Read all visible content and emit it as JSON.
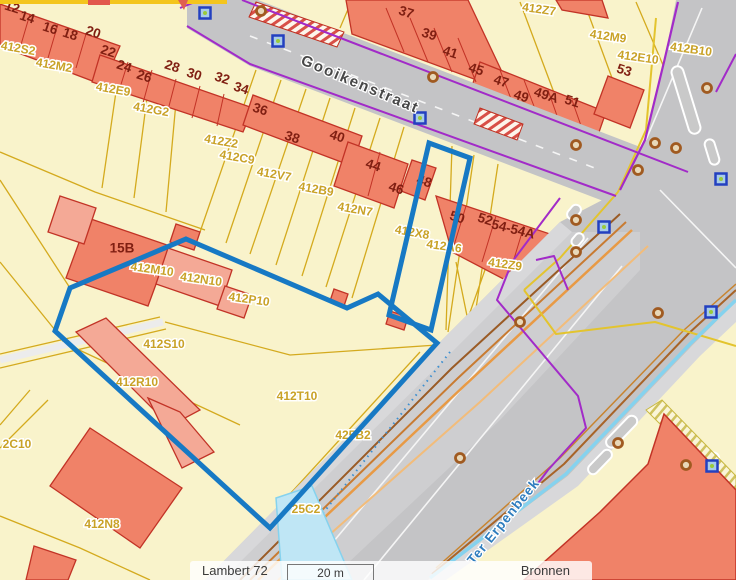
{
  "status_bar": {
    "projection": "Lambert 72",
    "scale_text": "20 m",
    "sources_label": "Bronnen"
  },
  "colors": {
    "selection_blue": "#1779C4",
    "building_fill": "#F08268",
    "building_light": "#F4A996",
    "building_border": "#C23326",
    "parcel_fill": "#F9F3CB",
    "parcel_line": "#D4AA1E",
    "road_gray": "#C4C4C6",
    "sidewalk_gray": "#D8D8DA",
    "utility_purple": "#A22BC8",
    "stream_cyan": "#85D2EE",
    "parcel_label": "#C9A227",
    "house_number": "#801F12",
    "street_label_gray": "#474747",
    "water_label_blue": "#2F7DBE",
    "marker_blue_border": "#2340C0",
    "marker_blue_fill": "#A8CCE8",
    "marker_dot_green": "#9ACB3A",
    "manhole_brown": "#A05A20"
  },
  "map": {
    "street_labels": [
      {
        "t": "Gooikenstraat",
        "x": 360,
        "y": 85,
        "r": 23,
        "color": "#474747",
        "size": 15,
        "spacing": 2
      },
      {
        "t": "Ter Erpenbeek",
        "x": 504,
        "y": 522,
        "r": -51,
        "color": "#2F7DBE",
        "size": 13.5,
        "spacing": 1
      }
    ],
    "house_numbers": [
      {
        "t": "12",
        "x": 12,
        "y": 8,
        "r": 18
      },
      {
        "t": "14",
        "x": 27,
        "y": 18,
        "r": 18
      },
      {
        "t": "16",
        "x": 50,
        "y": 29,
        "r": 18
      },
      {
        "t": "18",
        "x": 70,
        "y": 35,
        "r": 18
      },
      {
        "t": "20",
        "x": 93,
        "y": 33,
        "r": 18
      },
      {
        "t": "22",
        "x": 108,
        "y": 52,
        "r": 18
      },
      {
        "t": "24",
        "x": 124,
        "y": 67,
        "r": 18
      },
      {
        "t": "26",
        "x": 144,
        "y": 77,
        "r": 18
      },
      {
        "t": "28",
        "x": 172,
        "y": 67,
        "r": 18
      },
      {
        "t": "30",
        "x": 194,
        "y": 75,
        "r": 18
      },
      {
        "t": "32",
        "x": 222,
        "y": 79,
        "r": 18
      },
      {
        "t": "34",
        "x": 241,
        "y": 89,
        "r": 18
      },
      {
        "t": "36",
        "x": 260,
        "y": 110,
        "r": 18
      },
      {
        "t": "38",
        "x": 292,
        "y": 138,
        "r": 18
      },
      {
        "t": "40",
        "x": 337,
        "y": 137,
        "r": 18
      },
      {
        "t": "37",
        "x": 406,
        "y": 13,
        "r": 18
      },
      {
        "t": "39",
        "x": 429,
        "y": 35,
        "r": 18
      },
      {
        "t": "41",
        "x": 450,
        "y": 53,
        "r": 18
      },
      {
        "t": "45",
        "x": 476,
        "y": 70,
        "r": 18
      },
      {
        "t": "47",
        "x": 501,
        "y": 82,
        "r": 18
      },
      {
        "t": "49",
        "x": 521,
        "y": 97,
        "r": 18
      },
      {
        "t": "49A",
        "x": 546,
        "y": 96,
        "r": 18
      },
      {
        "t": "51",
        "x": 572,
        "y": 102,
        "r": 18
      },
      {
        "t": "53",
        "x": 624,
        "y": 71,
        "r": 18
      },
      {
        "t": "44",
        "x": 373,
        "y": 166,
        "r": 18
      },
      {
        "t": "46",
        "x": 396,
        "y": 189,
        "r": 18
      },
      {
        "t": "48",
        "x": 424,
        "y": 182,
        "r": 18
      },
      {
        "t": "50",
        "x": 457,
        "y": 218,
        "r": 18
      },
      {
        "t": "52",
        "x": 485,
        "y": 220,
        "r": 18
      },
      {
        "t": "54-54A",
        "x": 513,
        "y": 230,
        "r": 14,
        "s": 15
      },
      {
        "t": "15B",
        "x": 122,
        "y": 249,
        "r": 0,
        "s": 15
      }
    ],
    "parcel_labels": [
      {
        "t": "412S2",
        "x": 18,
        "y": 49,
        "r": 10
      },
      {
        "t": "412M2",
        "x": 54,
        "y": 66,
        "r": 10
      },
      {
        "t": "412E9",
        "x": 113,
        "y": 90,
        "r": 10
      },
      {
        "t": "412G2",
        "x": 151,
        "y": 110,
        "r": 10
      },
      {
        "t": "412Z2",
        "x": 221,
        "y": 142,
        "r": 10
      },
      {
        "t": "412C9",
        "x": 237,
        "y": 158,
        "r": 10
      },
      {
        "t": "412V7",
        "x": 274,
        "y": 175,
        "r": 10
      },
      {
        "t": "412B9",
        "x": 316,
        "y": 190,
        "r": 10
      },
      {
        "t": "412N7",
        "x": 355,
        "y": 210,
        "r": 10
      },
      {
        "t": "412Z7",
        "x": 539,
        "y": 10,
        "r": 8
      },
      {
        "t": "412M9",
        "x": 608,
        "y": 37,
        "r": 8
      },
      {
        "t": "412E10",
        "x": 638,
        "y": 58,
        "r": 8
      },
      {
        "t": "412B10",
        "x": 691,
        "y": 50,
        "r": 8
      },
      {
        "t": "412X8",
        "x": 412,
        "y": 233,
        "r": 10
      },
      {
        "t": "412A6",
        "x": 444,
        "y": 247,
        "r": 8
      },
      {
        "t": "412Z9",
        "x": 505,
        "y": 265,
        "r": 8
      },
      {
        "t": "412M10",
        "x": 152,
        "y": 270,
        "r": 8
      },
      {
        "t": "412N10",
        "x": 201,
        "y": 280,
        "r": 8
      },
      {
        "t": "412P10",
        "x": 249,
        "y": 300,
        "r": 8
      },
      {
        "t": "412S10",
        "x": 164,
        "y": 345,
        "r": 0
      },
      {
        "t": "412R10",
        "x": 137,
        "y": 383,
        "r": 0
      },
      {
        "t": "412T10",
        "x": 297,
        "y": 397,
        "r": 0
      },
      {
        "t": "425B2",
        "x": 353,
        "y": 436,
        "r": 0
      },
      {
        "t": "25C2",
        "x": 306,
        "y": 510,
        "r": 0
      },
      {
        "t": "2C10",
        "x": 17,
        "y": 445,
        "r": 0
      },
      {
        "t": "412N8",
        "x": 102,
        "y": 525,
        "r": 0
      }
    ],
    "utility_markers": [
      {
        "x": 205,
        "y": 13
      },
      {
        "x": 278,
        "y": 41
      },
      {
        "x": 420,
        "y": 118
      },
      {
        "x": 604,
        "y": 227
      },
      {
        "x": 721,
        "y": 179
      },
      {
        "x": 711,
        "y": 312
      },
      {
        "x": 712,
        "y": 466
      }
    ],
    "manhole_markers": [
      {
        "x": 261,
        "y": 11
      },
      {
        "x": 433,
        "y": 77
      },
      {
        "x": 576,
        "y": 145
      },
      {
        "x": 655,
        "y": 143
      },
      {
        "x": 676,
        "y": 148
      },
      {
        "x": 638,
        "y": 170
      },
      {
        "x": 707,
        "y": 88
      },
      {
        "x": 576,
        "y": 220
      },
      {
        "x": 576,
        "y": 252
      },
      {
        "x": 520,
        "y": 322
      },
      {
        "x": 658,
        "y": 313
      },
      {
        "x": 618,
        "y": 443
      },
      {
        "x": 686,
        "y": 465
      },
      {
        "x": 460,
        "y": 458
      }
    ]
  }
}
